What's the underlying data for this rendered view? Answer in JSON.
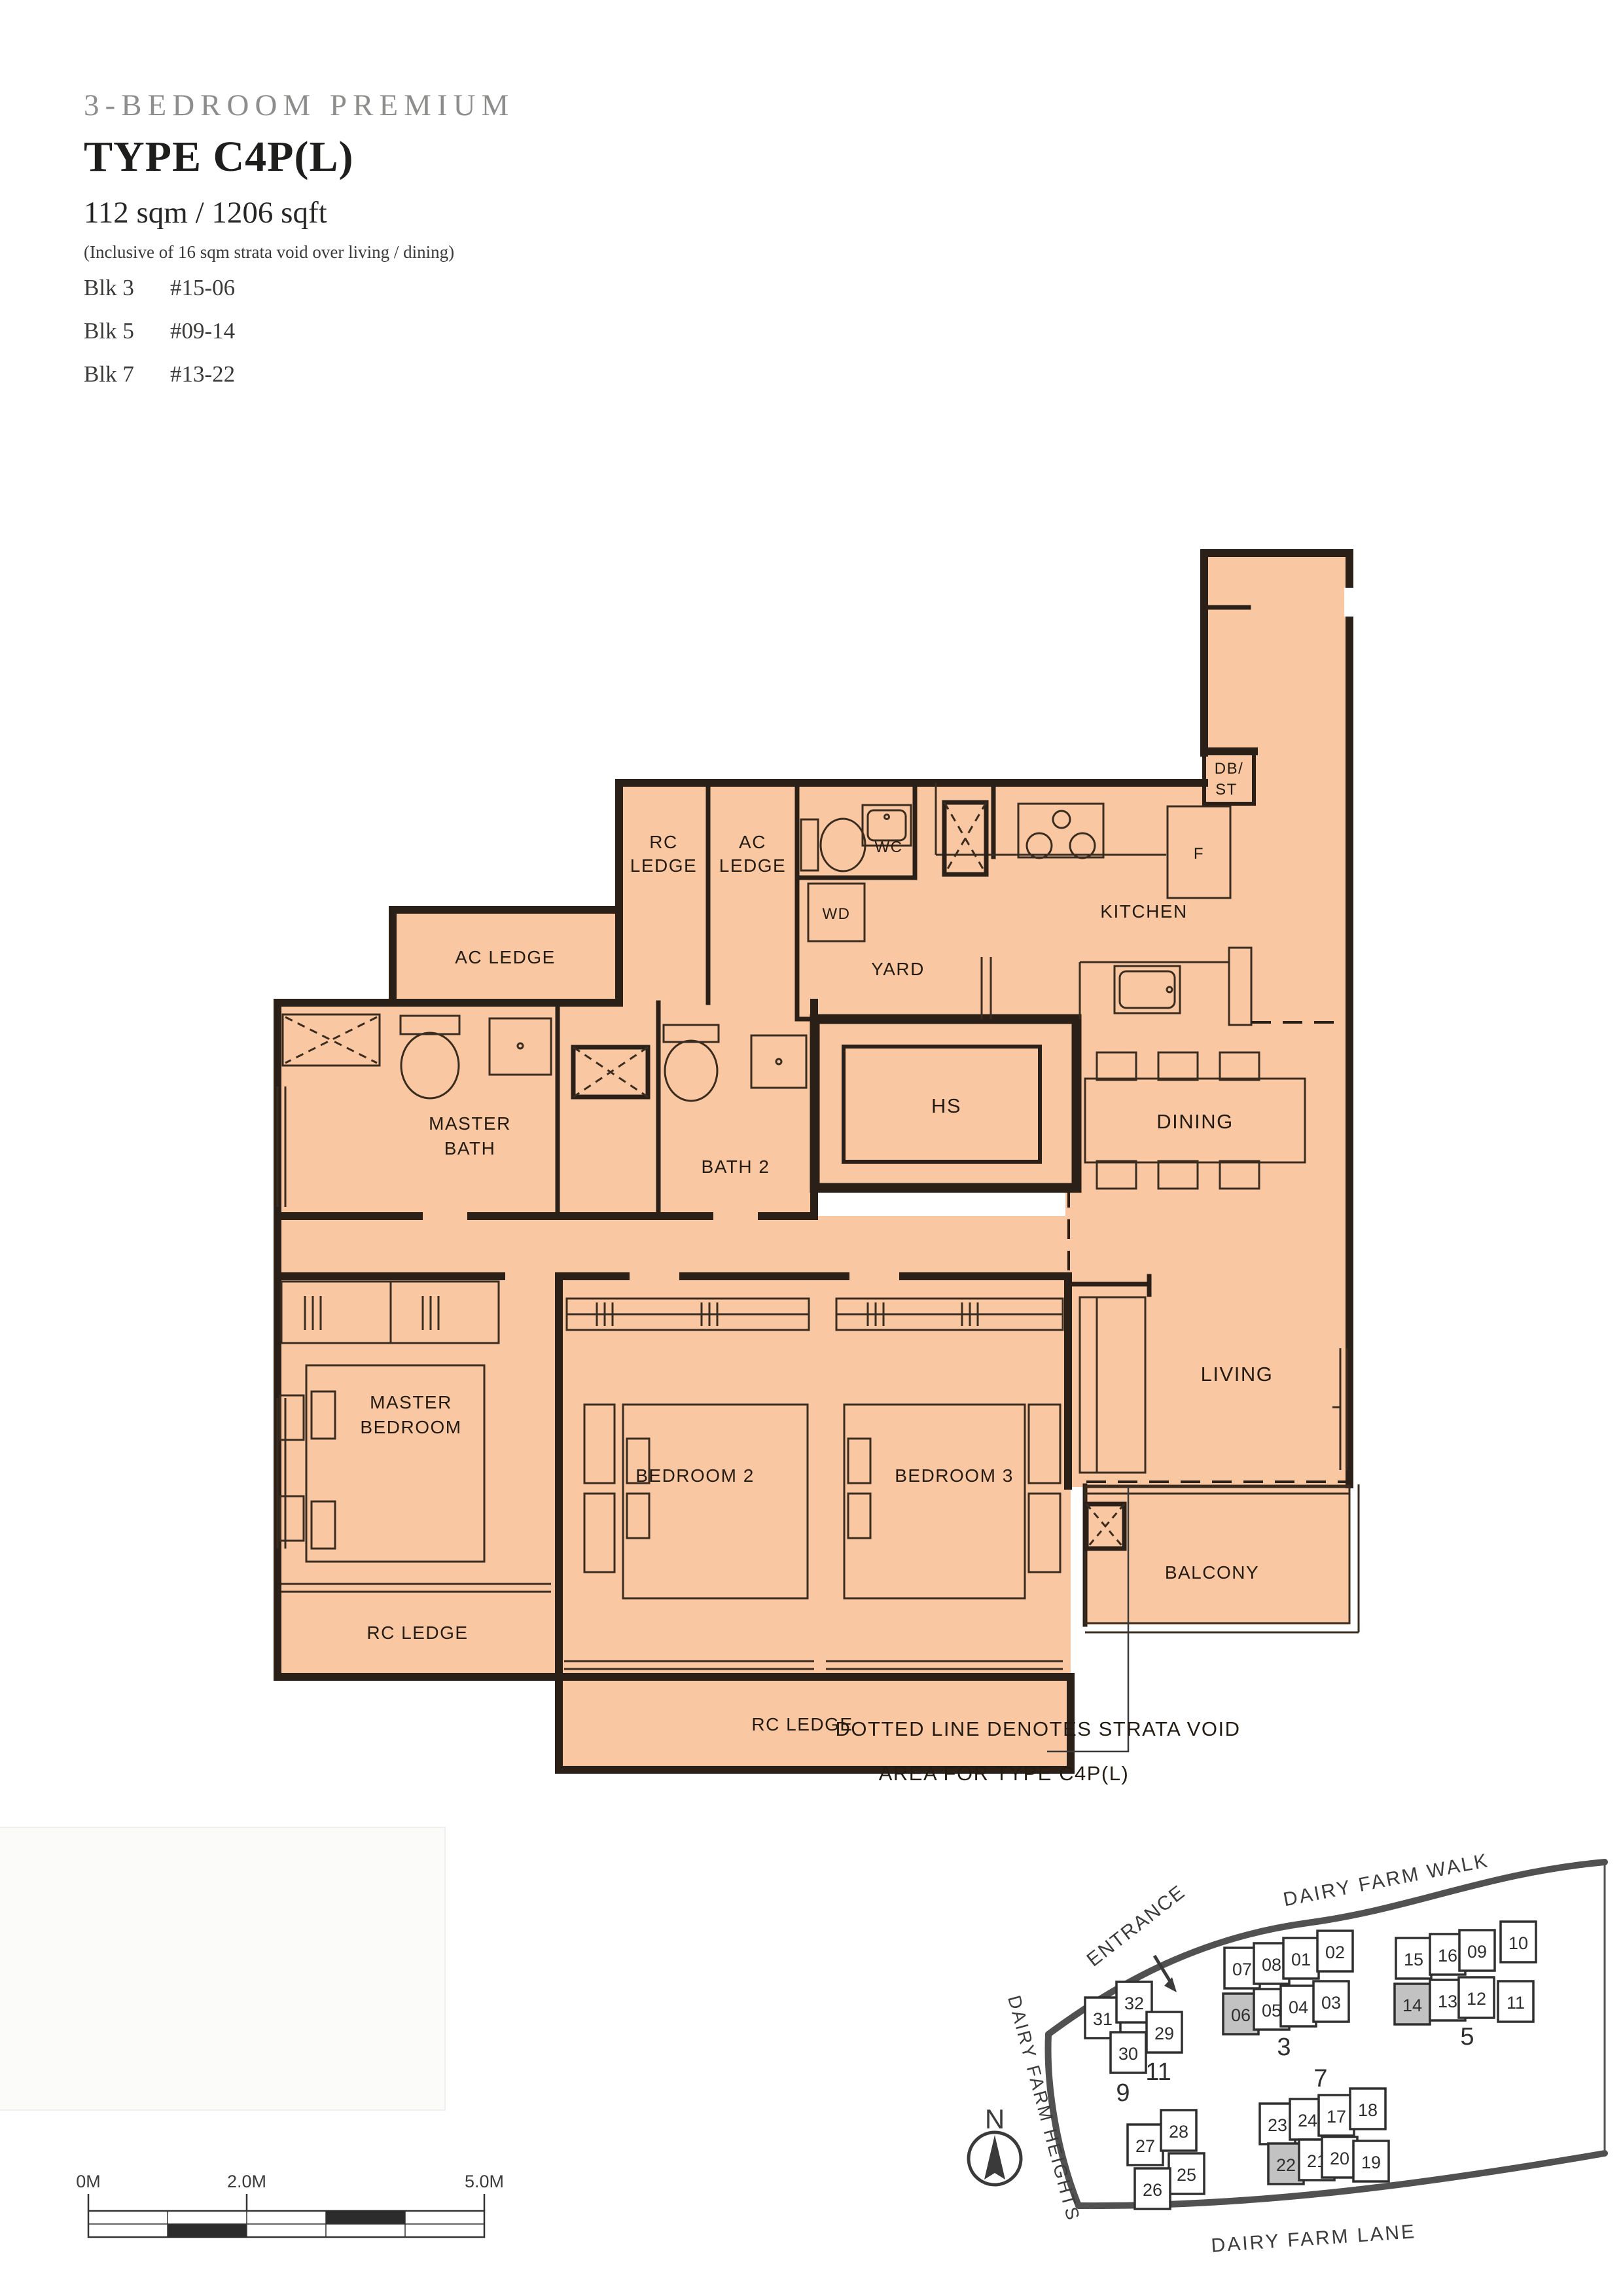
{
  "header": {
    "category": "3-BEDROOM PREMIUM",
    "type_title": "TYPE C4P(L)",
    "area": "112 sqm / 1206 sqft",
    "inclusive_note": "(Inclusive of 16 sqm strata void over living / dining)",
    "blocks": [
      {
        "blk": "Blk 3",
        "unit": "#15-06"
      },
      {
        "blk": "Blk 5",
        "unit": "#09-14"
      },
      {
        "blk": "Blk 7",
        "unit": "#13-22"
      }
    ]
  },
  "plan": {
    "labels": {
      "rc_ledge_line1": "RC",
      "rc_ledge_line2": "LEDGE",
      "ac_ledge_line1": "AC",
      "ac_ledge_line2": "LEDGE",
      "ac_ledge_box": "AC LEDGE",
      "wc": "WC",
      "wd": "WD",
      "yard": "YARD",
      "kitchen": "KITCHEN",
      "db_st_line1": "DB/",
      "db_st_line2": "ST",
      "fridge": "F",
      "master_bath_line1": "MASTER",
      "master_bath_line2": "BATH",
      "bath2": "BATH 2",
      "hs": "HS",
      "dining": "DINING",
      "living": "LIVING",
      "balcony": "BALCONY",
      "master_bedroom_line1": "MASTER",
      "master_bedroom_line2": "BEDROOM",
      "bedroom2": "BEDROOM 2",
      "bedroom3": "BEDROOM 3",
      "rc_ledge_left": "RC LEDGE",
      "rc_ledge_center": "RC LEDGE"
    },
    "colors": {
      "room_fill": "#f9c7a1",
      "wall": "#2a2018",
      "site_shaded": "#c2c2c2"
    }
  },
  "strata_note": {
    "line1": "DOTTED LINE DENOTES STRATA VOID",
    "line2": "AREA FOR TYPE C4P(L)"
  },
  "scale_bar": {
    "start": "0M",
    "mid": "2.0M",
    "end": "5.0M"
  },
  "site": {
    "roads": {
      "walk": "DAIRY FARM WALK",
      "lane": "DAIRY FARM LANE",
      "heights": "DAIRY FARM HEIGHTS"
    },
    "entrance": "ENTRANCE",
    "north": "N",
    "b3": {
      "label": "3",
      "units": [
        "07",
        "08",
        "01",
        "02",
        "06",
        "05",
        "04",
        "03"
      ]
    },
    "b5": {
      "label": "5",
      "units": [
        "15",
        "16",
        "09",
        "10",
        "14",
        "13",
        "12",
        "11"
      ]
    },
    "b11": {
      "label": "11",
      "units": [
        "31",
        "32",
        "29",
        "30"
      ]
    },
    "b9": {
      "label": "9",
      "units": [
        "27",
        "28",
        "25",
        "26"
      ]
    },
    "b7": {
      "label": "7",
      "units": [
        "23",
        "24",
        "17",
        "18",
        "22",
        "21",
        "20",
        "19"
      ]
    }
  }
}
